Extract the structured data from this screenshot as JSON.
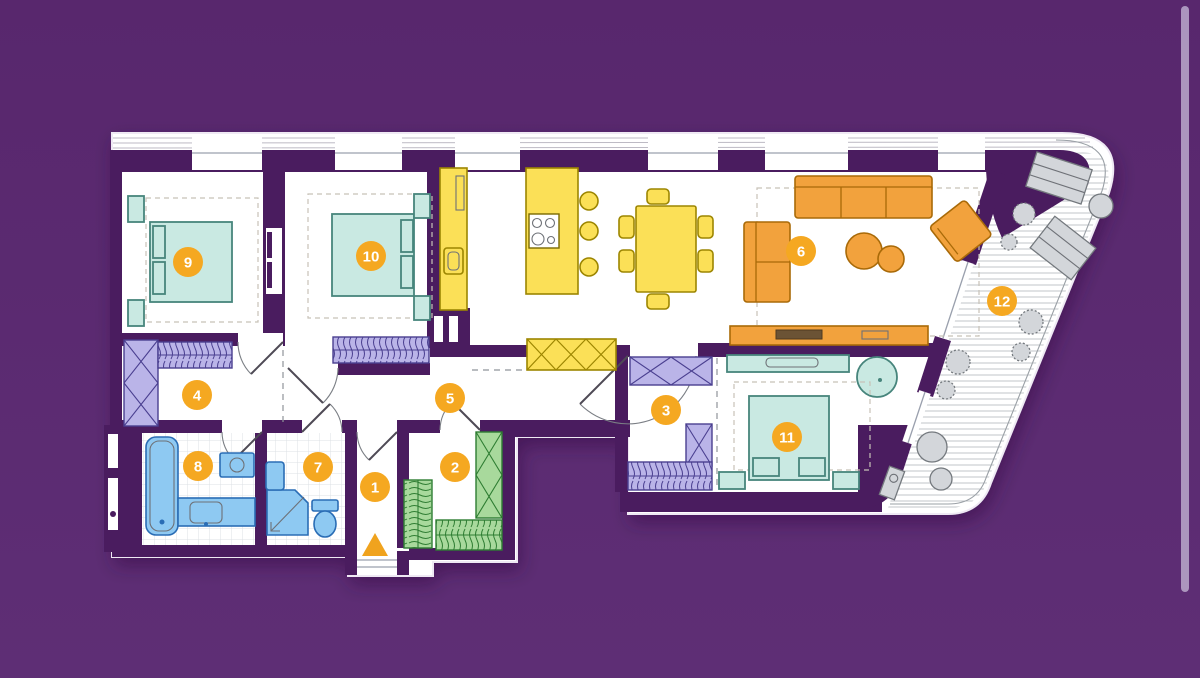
{
  "scene": {
    "background_top": "#58276d",
    "background_bottom": "#5e2e75"
  },
  "scrollbar": {
    "color": "#b5a2c7"
  },
  "palette": {
    "wall": "#4a1c5f",
    "floor": "#ffffff",
    "teal_fill": "#c9e9e2",
    "teal_stroke": "#47857c",
    "yellow_fill": "#fbe057",
    "yellow_stroke": "#9c8500",
    "orange_fill": "#f2a23d",
    "orange_stroke": "#a96a08",
    "lavender_fill": "#bab4e8",
    "lavender_stroke": "#4a3f90",
    "green_fill": "#a8d99c",
    "green_stroke": "#2e7d32",
    "blue_fill": "#8ec9f2",
    "blue_stroke": "#2a6db5",
    "gray_fill": "#d3d6da",
    "gray_stroke": "#74797e",
    "badge_fill": "#f5a821",
    "badge_text": "#ffffff",
    "entrance_arrow": "#f0a31e"
  },
  "room_badges": [
    {
      "number": "1",
      "x": 375,
      "y": 487
    },
    {
      "number": "2",
      "x": 455,
      "y": 467
    },
    {
      "number": "3",
      "x": 666,
      "y": 410
    },
    {
      "number": "4",
      "x": 197,
      "y": 395
    },
    {
      "number": "5",
      "x": 450,
      "y": 398
    },
    {
      "number": "6",
      "x": 801,
      "y": 251
    },
    {
      "number": "7",
      "x": 318,
      "y": 467
    },
    {
      "number": "8",
      "x": 198,
      "y": 466
    },
    {
      "number": "9",
      "x": 188,
      "y": 262
    },
    {
      "number": "10",
      "x": 371,
      "y": 256
    },
    {
      "number": "11",
      "x": 787,
      "y": 437
    },
    {
      "number": "12",
      "x": 1002,
      "y": 301
    }
  ]
}
